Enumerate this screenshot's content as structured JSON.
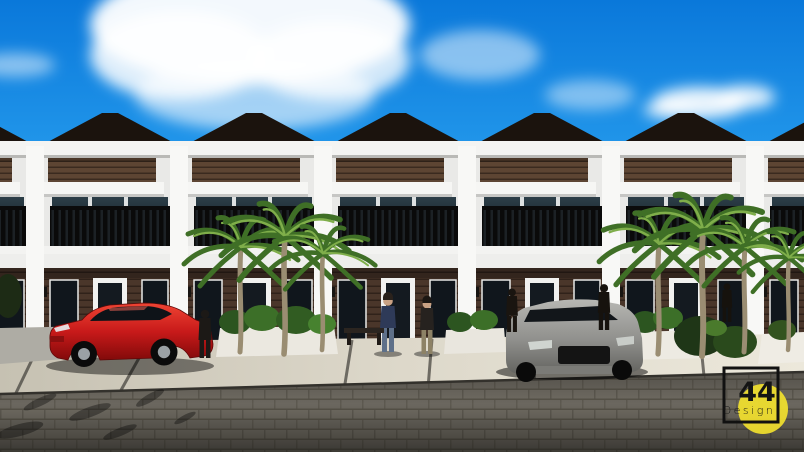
{
  "image": {
    "alt_text": "3D architectural rendering of a row of modern two-story townhouses with dark hip roofs, wood-slat accent bands, black balcony railings, palm trees, a red sedan and a gray car parked on a paver driveway under a bright blue sky with clouds"
  },
  "watermark": {
    "number": "44",
    "word": "Design"
  },
  "palette": {
    "sky_top": "#0a78da",
    "sky_mid": "#2196ea",
    "sky_low": "#7ac6f5",
    "cloud": "#ffffff",
    "roof": "#1b130d",
    "fascia": "#f4f4f2",
    "wall": "#e9e9e7",
    "wall_bright": "#f8f8f6",
    "wood_accent": "#5d4533",
    "wood_ground": "#4a362a",
    "glass_dark": "#10181f",
    "railing": "#0b0b0b",
    "balcony": "#f3f3f1",
    "planter": "#ebe8e0",
    "concrete": "#ddd8ca",
    "road": "#6b675f",
    "palm_green": "#3f6f26",
    "palm_light": "#7fae4a",
    "trunk": "#9a8d72",
    "car_red": "#c81a1a",
    "car_gray": "#8f8f8c",
    "skin": "#c9a183",
    "sweater_blue": "#2e3a58",
    "jeans": "#5e7089",
    "logo_yellow": "#f2e12e",
    "logo_ink": "#141414"
  }
}
